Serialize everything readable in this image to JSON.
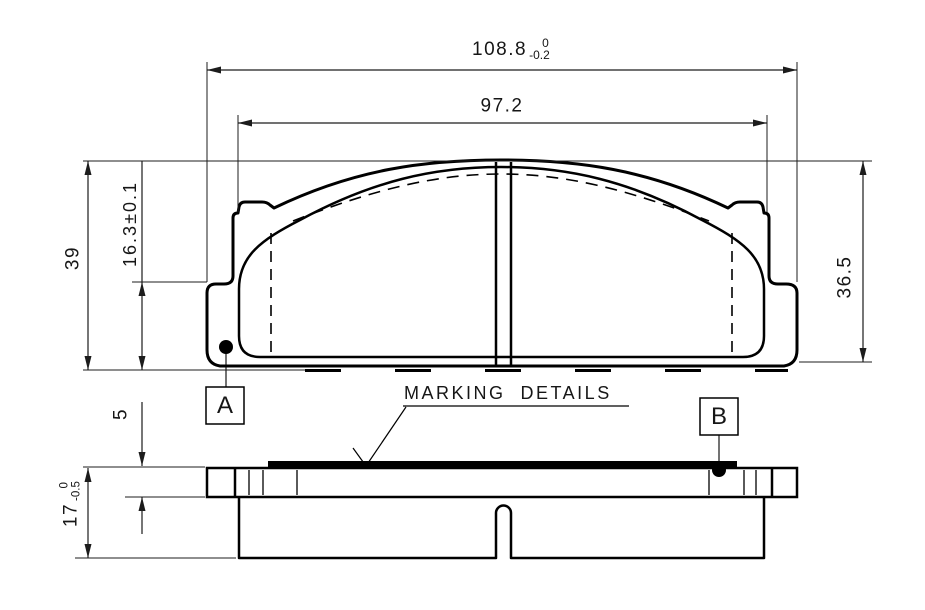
{
  "app": {
    "background": "#ffffff",
    "ink": "#000000"
  },
  "front_view": {
    "dim_overall_width": {
      "value": "108.8",
      "tol_upper": "0",
      "tol_lower": "-0.2"
    },
    "dim_friction_width": {
      "value": "97.2"
    },
    "dim_overall_height": {
      "value": "39"
    },
    "dim_lower_height": {
      "value": "16.3±0.1"
    },
    "dim_right_height": {
      "value": "36.5"
    },
    "datum_a": "A"
  },
  "side_view": {
    "dim_plate_thickness": {
      "value": "5"
    },
    "dim_total_thickness": {
      "value": "17",
      "tol_upper": "0",
      "tol_lower": "-0.5"
    },
    "datum_b": "B",
    "marking_note": "MARKING  DETAILS"
  }
}
